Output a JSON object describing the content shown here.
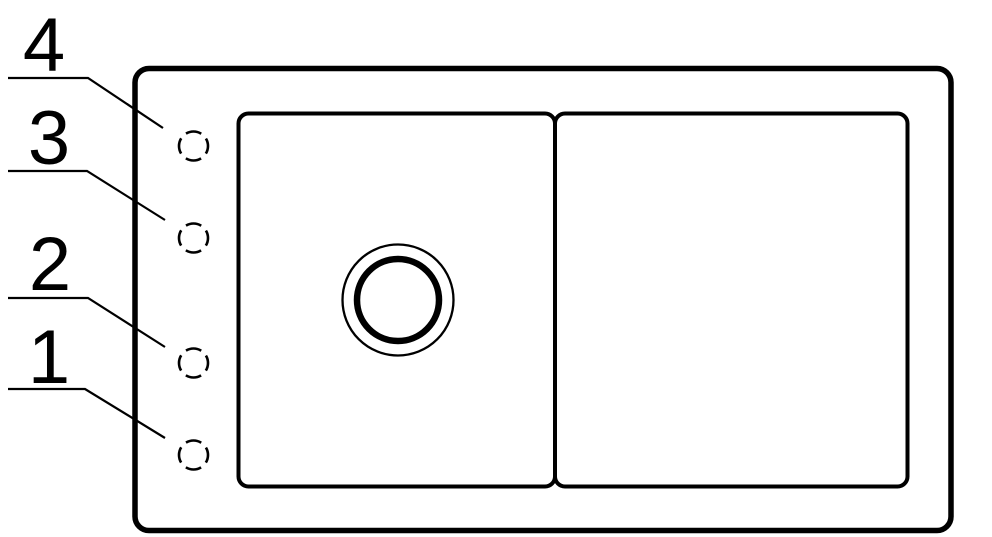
{
  "diagram": {
    "colors": {
      "line": "#000000",
      "background": "#ffffff"
    },
    "callouts": [
      {
        "label": "1"
      },
      {
        "label": "2"
      },
      {
        "label": "3"
      },
      {
        "label": "4"
      }
    ]
  }
}
